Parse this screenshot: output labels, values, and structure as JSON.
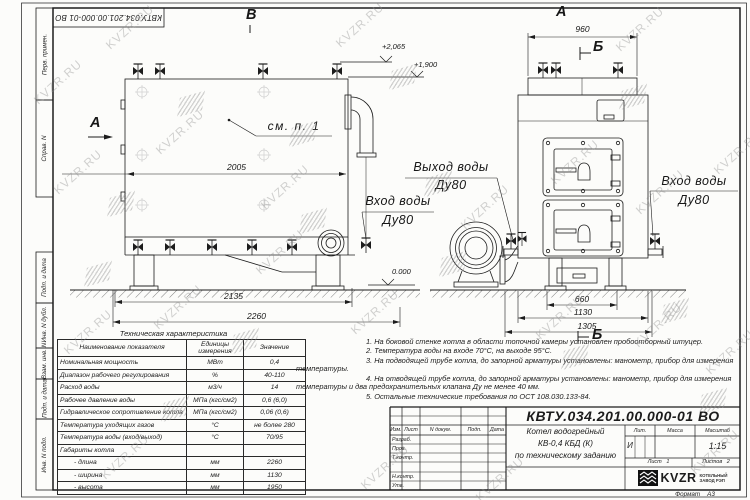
{
  "watermark": {
    "text": "KVZR.RU"
  },
  "side_stamps": {
    "items": [
      "Перв. примен.",
      "Справ. N",
      "Подп. и дата",
      "Инв. N дубл.",
      "Взам. инв. N",
      "Подп. и дата",
      "Инв. N подл."
    ]
  },
  "drawing": {
    "view_labels": {
      "a_left": "А",
      "v_top": "В",
      "a_right": "А",
      "b_top": "Б",
      "b_bottom": "Б"
    },
    "callouts": {
      "see_note": "см. п. 1",
      "outlet_line1": "Выход воды",
      "outlet_line2": "Ду80",
      "inlet_left_line1": "Вход воды",
      "inlet_left_line2": "Ду80",
      "inlet_right_line1": "Вход воды",
      "inlet_right_line2": "Ду80"
    },
    "dimensions": {
      "boiler_length": "2005",
      "base_length": "2135",
      "total_length": "2260",
      "top_width": "960",
      "support_width": "660",
      "body_width": "1130",
      "total_width": "1305"
    },
    "elevations": {
      "top": "+2,065",
      "boiler_top": "+1,900",
      "ground": "0.000"
    }
  },
  "tech_table": {
    "title": "Техническая характеристика",
    "headers": [
      "Наименование показателя",
      "Единицы измерения",
      "Значение"
    ],
    "rows": [
      [
        "Номинальная мощность",
        "МВт",
        "0,4"
      ],
      [
        "Диапазон рабочего регулирования",
        "%",
        "40-110"
      ],
      [
        "Расход воды",
        "м3/ч",
        "14"
      ],
      [
        "Рабочее давление воды",
        "МПа (кгс/см2)",
        "0,6 (6,0)"
      ],
      [
        "Гидравлическое сопротивление котла",
        "МПа (кгс/см2)",
        "0,06 (0,6)"
      ],
      [
        "Температура уходящих газов",
        "°С",
        "не более 280"
      ],
      [
        "Температура воды (вход/выход)",
        "°С",
        "70/95"
      ],
      [
        "Габариты котла",
        "",
        ""
      ],
      [
        "- длина",
        "мм",
        "2260"
      ],
      [
        "- ширина",
        "мм",
        "1130"
      ],
      [
        "- высота",
        "мм",
        "1950"
      ]
    ]
  },
  "notes": {
    "items": [
      "1. На боковой стенке котла в области топочной камеры установлен пробоотборный штуцер.",
      "2. Температура воды на входе 70°С, на выходе 95°С.",
      "3. На подводящей трубе котла, до запорной арматуры установлены: манометр, прибор для измерения температуры.",
      "4. На отводящей трубе котла, до запорной арматуры установлены: манометр, прибор для измерения температуры и два предохранительных клапана Ду не менее 40 мм.",
      "5. Остальные технические требования по ОСТ 108.030.133-84."
    ]
  },
  "title_block": {
    "designation": "КВТУ.034.201.00.000-01 ВО",
    "doc_name_line1": "Котел водогрейный",
    "doc_name_line2": "КВ-0,4 КБД (К)",
    "doc_name_line3": "по техническому заданию",
    "col_headers": [
      "Изм.",
      "Лист",
      "N докум.",
      "Подп.",
      "Дата"
    ],
    "row_labels": [
      "Разраб.",
      "Пров.",
      "Т.контр.",
      "Н.контр.",
      "Утв."
    ],
    "lit_label": "Лит.",
    "lit_value": "И",
    "mass_label": "Масса",
    "scale_label": "Масштаб",
    "scale_value": "1:15",
    "sheet_label": "Лист",
    "sheet_value": "1",
    "sheets_label": "Листов",
    "sheets_value": "2",
    "logo_text": "KVZR",
    "logo_sub1": "КОТЕЛЬНЫЙ",
    "logo_sub2": "ЗАВОД РЭП",
    "format_label": "Формат",
    "format_value": "А3"
  }
}
